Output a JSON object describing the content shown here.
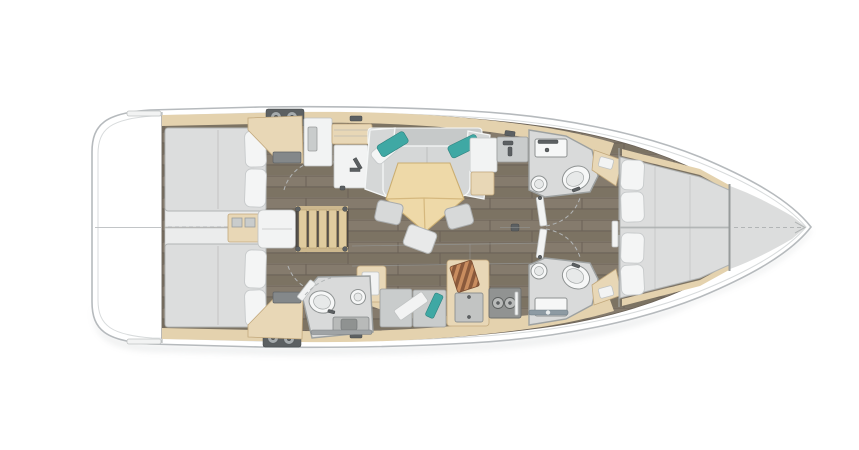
{
  "palette": {
    "hull_outline": "#b6babd",
    "hull_inner_line": "#d8dbdc",
    "deck_white": "#ffffff",
    "floor_wood": "#7e7568",
    "floor_wood_light": "#897f71",
    "floor_seam": "#6b6257",
    "trim_beige": "#e8d7b6",
    "trim_beige_soft": "#e4d2ae",
    "trim_beige_border": "#c2a87c",
    "mattress": "#dcdddd",
    "pillow": "#f4f5f5",
    "sofa": "#d5d7d7",
    "accent_teal": "#3fa8a4",
    "table_wood": "#eed9a8",
    "head_floor": "#d9dada",
    "fixture_white": "#f6f7f7",
    "dark_panel": "#5c6062",
    "stove": "#919392",
    "cutting_board_dark": "#8a5a3c",
    "cutting_board_light": "#c98d5f"
  },
  "plan": {
    "vessel": "Sailing yacht interior layout plan, bow pointing right",
    "regions": {
      "aft_deck": "Stern deck / transom platform",
      "aft_cabin_starboard": "Aft double cabin (top) with mattress and two pillows",
      "aft_cabin_port": "Aft double cabin (bottom) with mattress and two pillows",
      "companionway": "Companionway ladder with engine box and deck winches",
      "nav_station": "Chart table / nav station with wardrobe",
      "salon": "Salon with L-shaped sofa, teal pillows, pentagonal table and three stools",
      "galley": "Port galley with twin sinks, teal towel, cutting board, oven and two-burner stove",
      "aft_head": "Aft head with toilet, shower and sink",
      "head_starboard": "Forward head (top) with vanity, basin and toilet",
      "head_port": "Forward head (bottom) with vanity, basin and toilet",
      "corridor": "Centerline corridor to forward cabin",
      "forward_cabin": "Forward V-berth cabin with four pillows",
      "bow_locker": "Bow anchor locker with dashed centerline"
    }
  }
}
